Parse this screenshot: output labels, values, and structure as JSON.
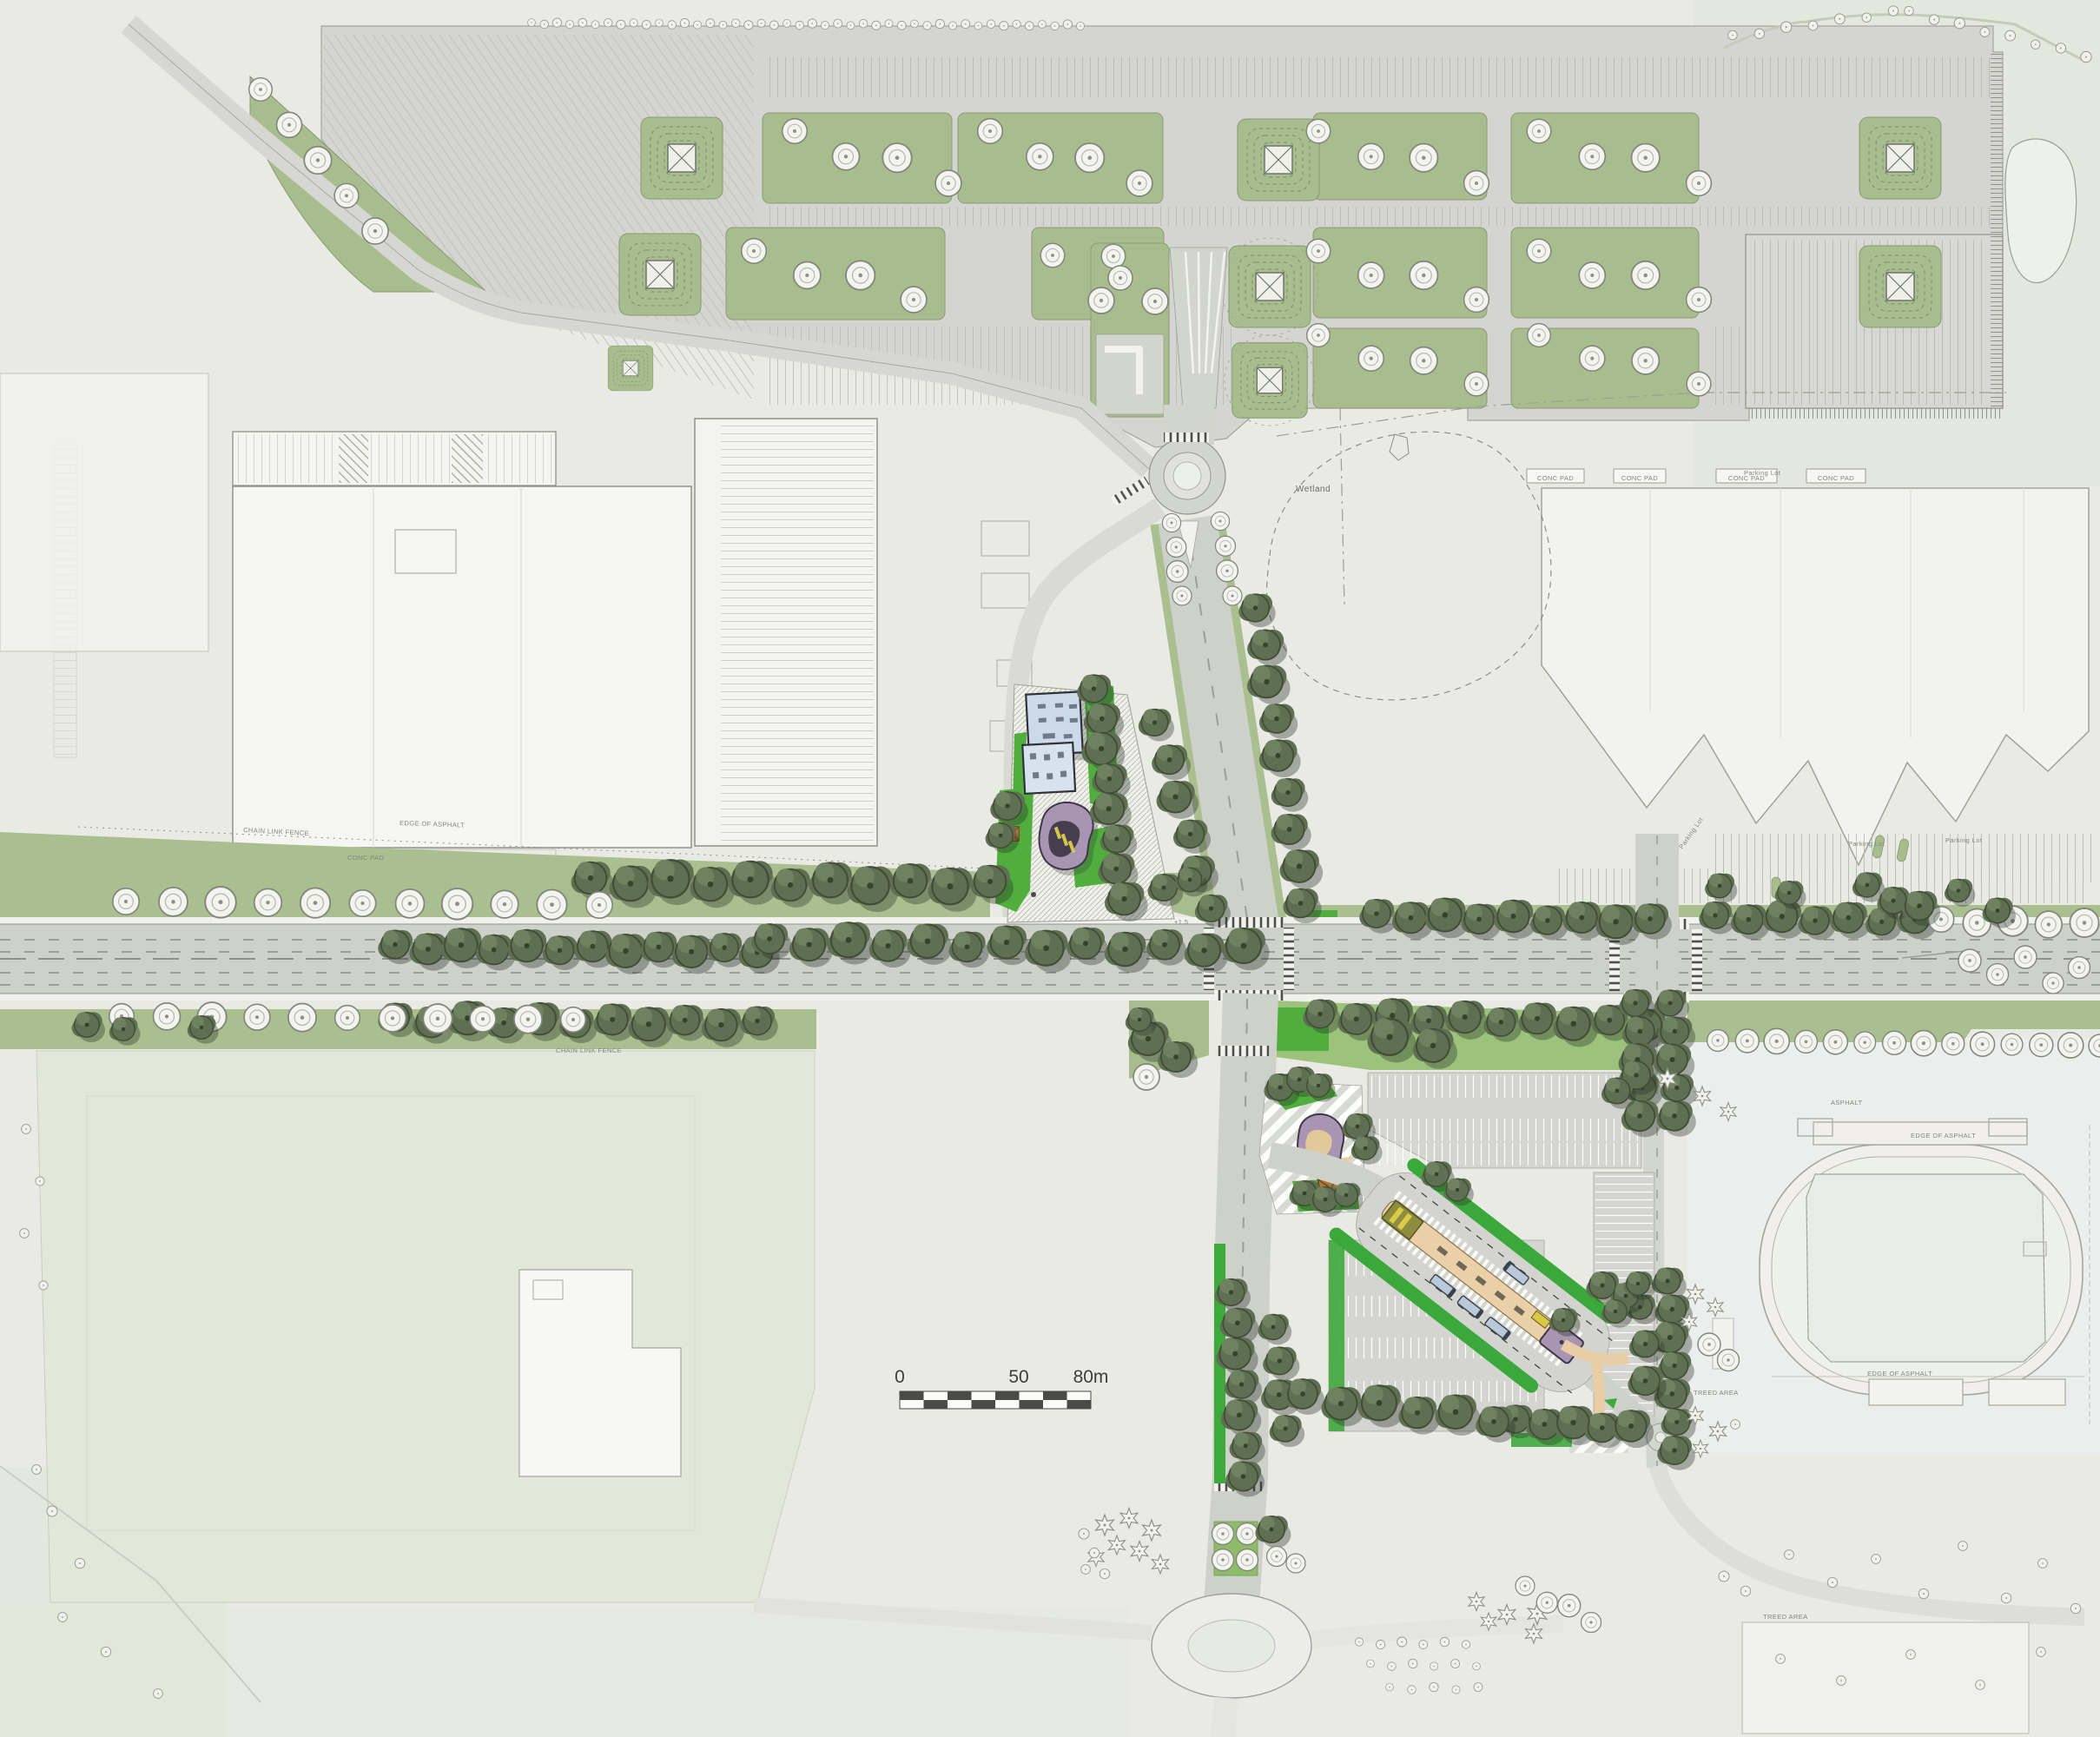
{
  "map": {
    "title": "Landscape site plan",
    "labels": {
      "wetland": "Wetland",
      "parking_lot": "Parking Lot",
      "conc_pad": "CONC PAD",
      "treed_area": "TREED AREA",
      "edge_of_asphalt": "EDGE OF ASPHALT",
      "chain_link_fence": "CHAIN LINK FENCE",
      "asphalt": "ASPHALT",
      "plus_level": "+1.5"
    },
    "scale_bar": {
      "zero": "0",
      "fifty": "50",
      "eighty": "80m",
      "segments": 8,
      "meters_per_segment": 10
    },
    "symbols": {
      "dark_tree": "proposed-tree",
      "white_tree": "existing-tree",
      "star_tree": "existing-conifer-tree",
      "blossom_tree": "small-ornamental-tree",
      "basin": "attenuation-basin",
      "play_pad": "play-equipment-pad"
    },
    "palette": {
      "background": "#e9eae4",
      "asphalt_parking": "#d4d5d0",
      "road": "#ced0ca",
      "landscape_sage": "#a7bd8d",
      "verge_green": "#aabf90",
      "lawn_bright": "#4fae3e",
      "ribbon_green": "#3aa83a",
      "buffer_green": "#9cc27c",
      "field_pale": "#e2e7d9",
      "tree_dark": "#5f7052",
      "tree_outline": "#82867b",
      "building_blue": "#ccd9e8",
      "building_purple": "#a795b3",
      "platform_tan": "#ebcfa6",
      "bus_blue": "#b9c9da",
      "canopy_yellow": "#d8c844",
      "play_equipment_brown": "#ad743b",
      "scale_bar_dark": "#4a4a46",
      "line_grey": "#9a9d95"
    }
  }
}
